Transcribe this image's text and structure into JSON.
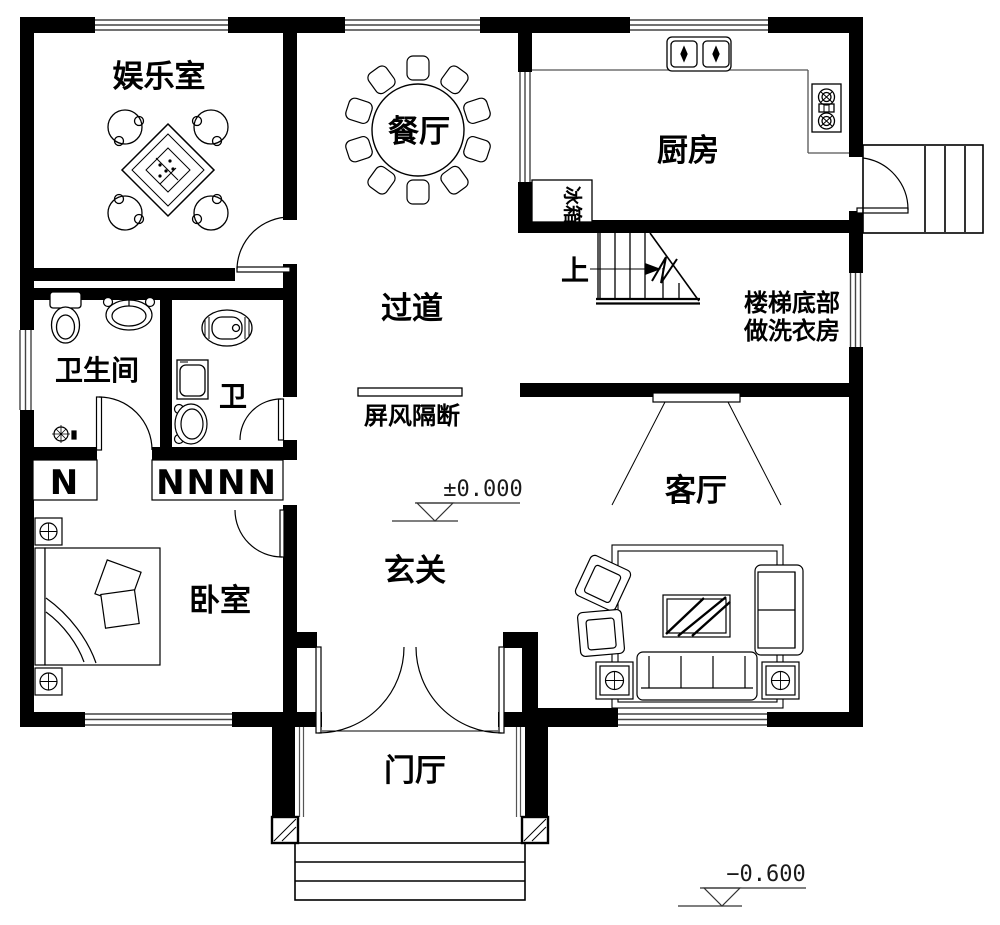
{
  "rooms": {
    "entertainment": "娱乐室",
    "dining": "餐厅",
    "kitchen": "厨房",
    "hallway": "过道",
    "bathroom": "卫生间",
    "toilet": "卫",
    "living": "客厅",
    "entry": "玄关",
    "bedroom": "卧室",
    "foyer": "门厅"
  },
  "annotations": {
    "stairs_up": "上",
    "laundry_line1": "楼梯底部",
    "laundry_line2": "做洗衣房",
    "screen": "屏风隔断",
    "fridge": "冰箱",
    "level_entry": "±0.000",
    "level_outside": "−0.600",
    "wardrobe_single": "N",
    "wardrobe_row": "NNNN"
  },
  "colors": {
    "line": "#000000",
    "background": "#ffffff"
  }
}
